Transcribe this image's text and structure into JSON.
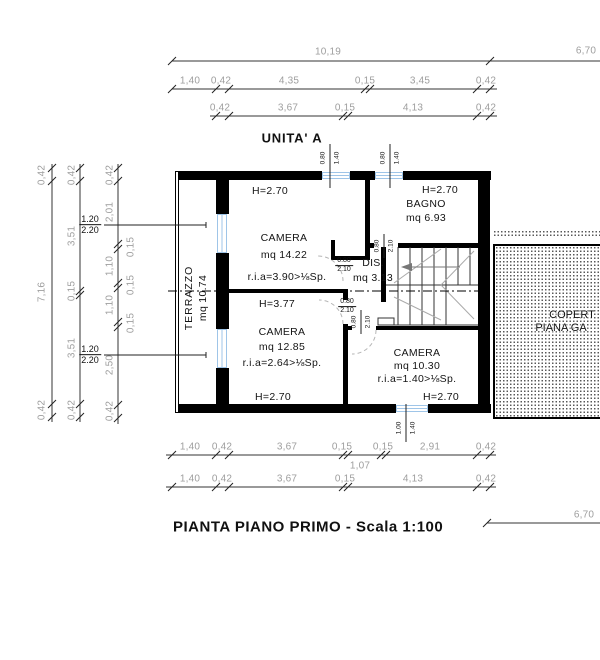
{
  "header": {
    "unit_label": "UNITA' A"
  },
  "title": "PIANTA PIANO PRIMO - Scala 1:100",
  "colors": {
    "wall": "#000000",
    "dim_text": "#9e9e9e",
    "window": "#9fc5e8",
    "hatch_dot": "#555555"
  },
  "dims": {
    "top1": {
      "total": "10,19",
      "garage": "6,70"
    },
    "top2": [
      "1,40",
      "0,42",
      "4,35",
      "0,15",
      "3,45",
      "0,42"
    ],
    "top3": [
      "0,42",
      "3,67",
      "0,15",
      "4,13",
      "0,42"
    ],
    "left1": [
      "0,42",
      "7,16",
      "0,42"
    ],
    "left2": [
      "0,42",
      "3,51",
      "0,15",
      "3,51",
      "0,42"
    ],
    "left3": [
      "0,42",
      "2,01",
      "1,10",
      "1,10",
      "2,50",
      "0,42"
    ],
    "left3_small": [
      "0,15",
      "0,15",
      "0,15"
    ],
    "bottom1": [
      "1,40",
      "0,42",
      "3,67",
      "0,15",
      "0,15",
      "2,91",
      "0,42"
    ],
    "bottom1_below": "1,07",
    "bottom2": [
      "1,40",
      "0,42",
      "3,67",
      "0,15",
      "4,13",
      "0,42"
    ],
    "bottom3_garage": "6,70"
  },
  "rooms": {
    "terrazzo": {
      "name": "TERRAZZO",
      "area": "mq 10.74"
    },
    "camera1": {
      "height": "H=2.70",
      "name": "CAMERA",
      "area": "mq 14.22",
      "ria": "r.i.a=3.90>⅛Sp."
    },
    "bagno": {
      "height": "H=2.70",
      "name": "BAGNO",
      "area": "mq 6.93"
    },
    "dis": {
      "name": "DIS.",
      "area": "mq 3.13"
    },
    "camera2": {
      "ridge_height": "H=3.77",
      "name": "CAMERA",
      "area": "mq 12.85",
      "ria": "r.i.a=2.64>⅛Sp.",
      "height": "H=2.70"
    },
    "camera3": {
      "name": "CAMERA",
      "area": "mq 10.30",
      "ria": "r.i.a=1.40>⅛Sp.",
      "height": "H=2.70"
    }
  },
  "openings": {
    "window_left": {
      "num": "1.20",
      "den": "2.20"
    },
    "window_top": {
      "num": "0.80",
      "den": "1.40"
    },
    "window_bottom": {
      "num": "1.00",
      "den": "1.40"
    },
    "door": {
      "num": "0.80",
      "den": "2.10"
    }
  },
  "garage": {
    "label_line1": "COPERT",
    "label_line2": "PIANA GA"
  }
}
